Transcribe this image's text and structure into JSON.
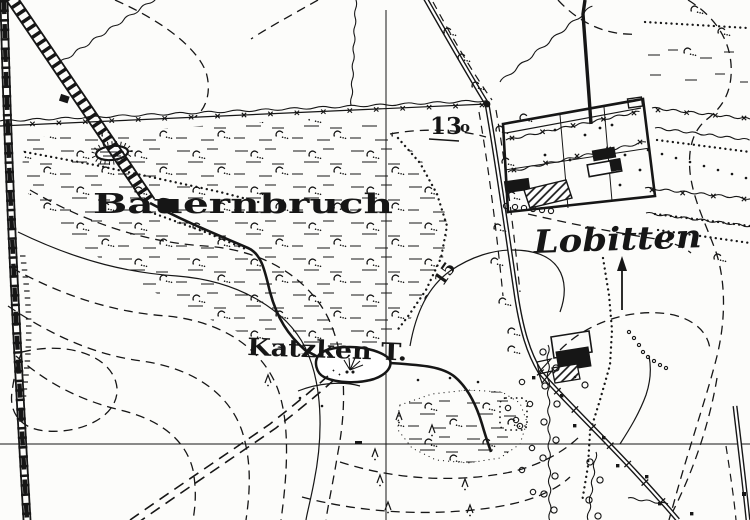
{
  "map": {
    "labels": {
      "bauernbruch": "Bauernbruch",
      "lobitten": "Lobitten",
      "katzken": "Katzken T.",
      "elevation_main": "13",
      "elevation_sub": "o",
      "contour_label": "15"
    },
    "colors": {
      "ink": "#161616",
      "paper": "#fcfcfa"
    }
  }
}
